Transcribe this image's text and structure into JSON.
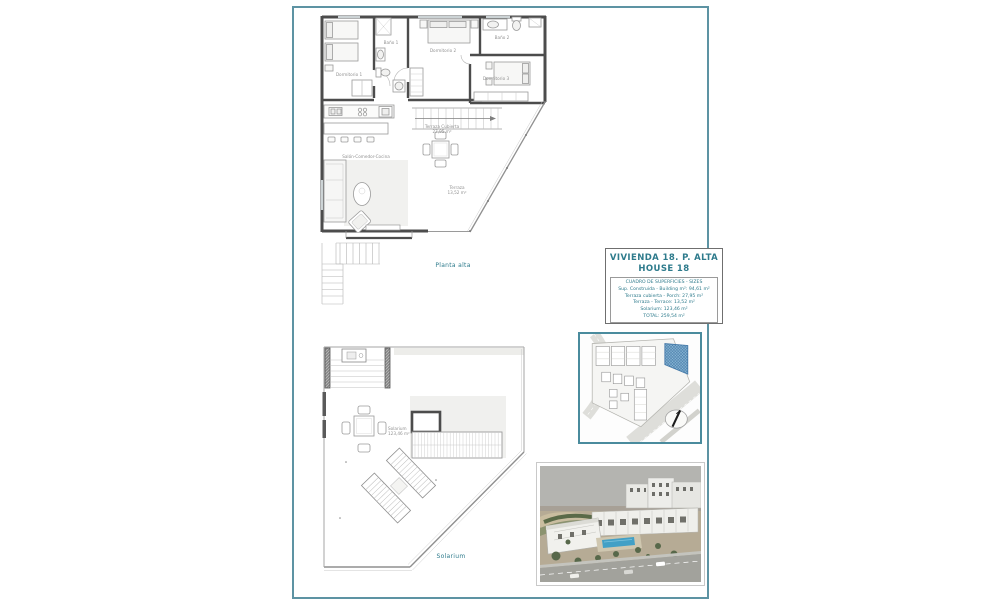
{
  "colors": {
    "frame_border": "#5d93a3",
    "accent_teal_text": "#2e7b8c",
    "site_plan_border": "#4a8b9d",
    "highlight_unit_blue": "#5b9bc0",
    "wall_dark": "#4c4c4c",
    "pool_blue": "#42a0c6"
  },
  "upper_plan": {
    "caption": "Planta alta",
    "labels": {
      "bedroom1": "Dormitorio 1",
      "bath1": "Baño 1",
      "bedroom2": "Dormitorio 2",
      "bath2": "Baño 2",
      "bedroom3": "Dormitorio 3",
      "living": "Salón-Comedor-Cocina",
      "covered_terrace": "Terraza Cubierta",
      "covered_terrace_area": "27,95 m²",
      "terrace": "Terraza",
      "terrace_area": "13,52 m²"
    }
  },
  "solarium_plan": {
    "caption": "Solarium",
    "label": "Solarium",
    "label_area": "123,46 m²"
  },
  "title_block": {
    "title": "VIVIENDA 18. P. ALTA",
    "subtitle": "HOUSE 18",
    "sizes": {
      "header": "CUADRO DE SUPERFICIES  - SIZES",
      "rows": [
        "Sup. Construida  - Building m²: 94,61 m²",
        "Terraza cubierta  - Porch: 27,95 m²",
        "Terraza - Terrace: 13,52 m²",
        "Solarium: 123,46 m²",
        "TOTAL: 259,54 m²"
      ]
    }
  }
}
